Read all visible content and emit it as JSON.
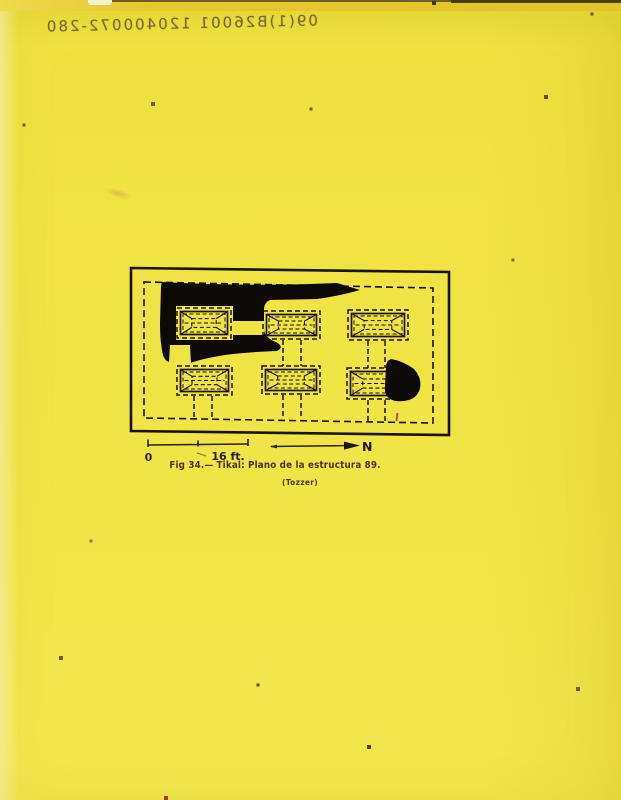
{
  "page": {
    "paper_color": "#f0e446",
    "top_band_color": "#e7c82e",
    "ink_color": "#1a130a"
  },
  "pencil_note": {
    "text": "09(1)B26001 120400072-280",
    "mirrored": true
  },
  "figure": {
    "caption": {
      "label": "Fig 34.—",
      "title": "Tikal: Plano de la estructura 89.",
      "credit": "(Tozzer)"
    },
    "scale": {
      "zero_label": "0",
      "length_label": "16 ft.",
      "north_label": "N"
    },
    "plan": {
      "type": "site-plan",
      "line_color": "#1a130a",
      "blot_color": "#0c0906",
      "outer_border_path": "M2,2 L320,6 L320,169 L2,165 Z",
      "boundary_dashed_path": "M15,16 L304,22 L304,157 L15,152 Z",
      "structures": [
        {
          "id": "platform-top-left",
          "x": 48,
          "y": 42,
          "w": 54,
          "h": 30
        },
        {
          "id": "platform-top-middle",
          "x": 134,
          "y": 45,
          "w": 57,
          "h": 28
        },
        {
          "id": "platform-top-right",
          "x": 219,
          "y": 44,
          "w": 60,
          "h": 30
        },
        {
          "id": "platform-bottom-left",
          "x": 48,
          "y": 100,
          "w": 55,
          "h": 29
        },
        {
          "id": "platform-bottom-middle",
          "x": 133,
          "y": 100,
          "w": 58,
          "h": 28
        },
        {
          "id": "platform-bottom-right",
          "x": 218,
          "y": 102,
          "w": 58,
          "h": 31
        }
      ],
      "stems": [
        {
          "x1": 154,
          "x2": 172,
          "y1": 74,
          "y2": 100
        },
        {
          "x1": 239,
          "x2": 256,
          "y1": 75,
          "y2": 102
        },
        {
          "x1": 65,
          "x2": 83,
          "y1": 130,
          "y2": 152
        },
        {
          "x1": 154,
          "x2": 172,
          "y1": 129,
          "y2": 153
        },
        {
          "x1": 239,
          "x2": 256,
          "y1": 134,
          "y2": 156
        }
      ],
      "ink_blots": [
        "M33,16 Q120,21 208,17 L231,24 Q210,30 188,33 L141,34 Q136,36 135,42 L135,64 Q136,72 147,76 Q156,81 148,85 Q118,86 96,89 Q77,92 64,96 L62,97 L61,79 L41,79 L40,96 Q36,95 34,89 Q31,77 31,57 L32,20 Z M47,40 L104,40 L104,55 L135,55 L135,69 L104,69 L104,74 L47,74 Z",
        "M262,93 Q274,95 285,103 Q293,112 291,122 Q289,131 280,134 Q268,137 261,133 Q255,129 256,120 L257,101 Q257,95 262,93 Z"
      ]
    }
  }
}
